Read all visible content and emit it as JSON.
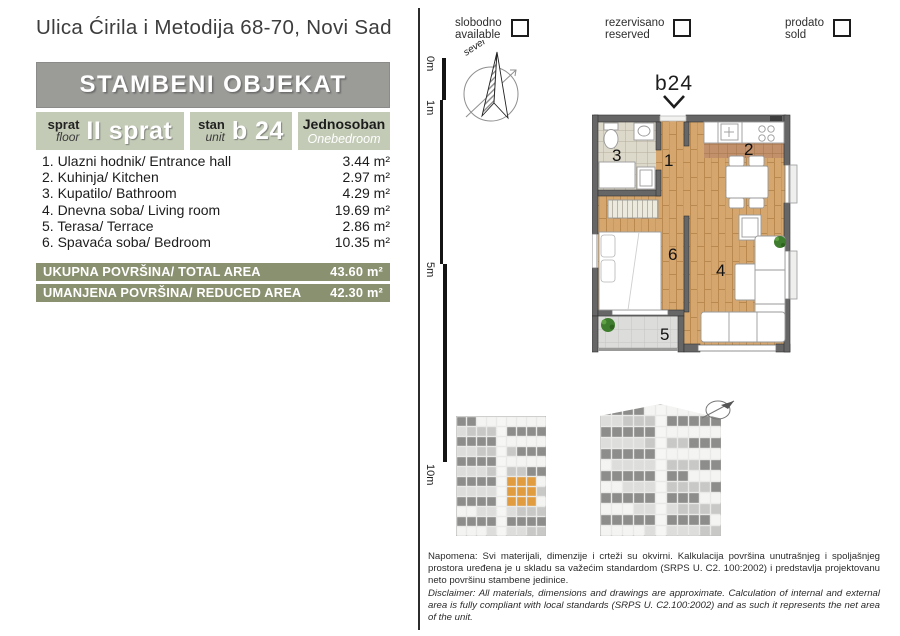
{
  "address": "Ulica Ćirila i Metodija 68-70, Novi Sad",
  "header": {
    "title": "STAMBENI OBJEKAT"
  },
  "unit": {
    "floor": {
      "sr": "sprat",
      "en": "floor",
      "value": "II sprat"
    },
    "stan": {
      "sr": "stan",
      "en": "unit",
      "value": "b 24"
    },
    "type": {
      "sr": "Jednosoban",
      "en": "Onebedroom"
    }
  },
  "rooms": [
    {
      "label": "1. Ulazni hodnik/ Entrance hall",
      "area": "3.44 m²"
    },
    {
      "label": "2. Kuhinja/ Kitchen",
      "area": "2.97 m²"
    },
    {
      "label": "3. Kupatilo/ Bathroom",
      "area": "4.29 m²"
    },
    {
      "label": "4. Dnevna soba/ Living room",
      "area": "19.69 m²"
    },
    {
      "label": "5. Terasa/ Terrace",
      "area": "2.86 m²"
    },
    {
      "label": "6. Spavaća soba/ Bedroom",
      "area": "10.35 m²"
    }
  ],
  "totals": [
    {
      "label": "UKUPNA POVRŠINA/ TOTAL AREA",
      "value": "43.60 m²"
    },
    {
      "label": "UMANJENA POVRŠINA/ REDUCED AREA",
      "value": "42.30 m²"
    }
  ],
  "legend": [
    {
      "sr": "slobodno",
      "en": "available"
    },
    {
      "sr": "rezervisano",
      "en": "reserved"
    },
    {
      "sr": "prodato",
      "en": "sold"
    }
  ],
  "scale_labels": [
    "0m",
    "1m",
    "5m",
    "10m"
  ],
  "compass": {
    "north_label": "sever"
  },
  "plan": {
    "unit_label": "b24",
    "room_numbers": {
      "hall": "1",
      "kitchen": "2",
      "bath": "3",
      "living": "4",
      "terrace": "5",
      "bedroom": "6"
    }
  },
  "disclaimer": {
    "sr": "Napomena: Svi materijali, dimenzije i crteži su okvirni. Kalkulacija površina unutrašnjeg i spoljašnjeg prostora uređena je u skladu sa važećim standardom (SRPS U. C2. 100:2002) i predstavlja projektovanu neto površinu stambene jedinice.",
    "en": "Disclaimer: All materials, dimensions and drawings are approximate. Calculation of internal and external area is fully compliant with local standards (SRPS U. C2.100:2002) and as such it represents the net area of the unit."
  },
  "colors": {
    "accent_olive": "#8a9170",
    "cell_sage": "#c3cbb6",
    "header_gray": "#9b9b98",
    "highlight_orange": "#e09c3f",
    "wood_floor": "#d5a76e",
    "wall_gray": "#666666"
  }
}
